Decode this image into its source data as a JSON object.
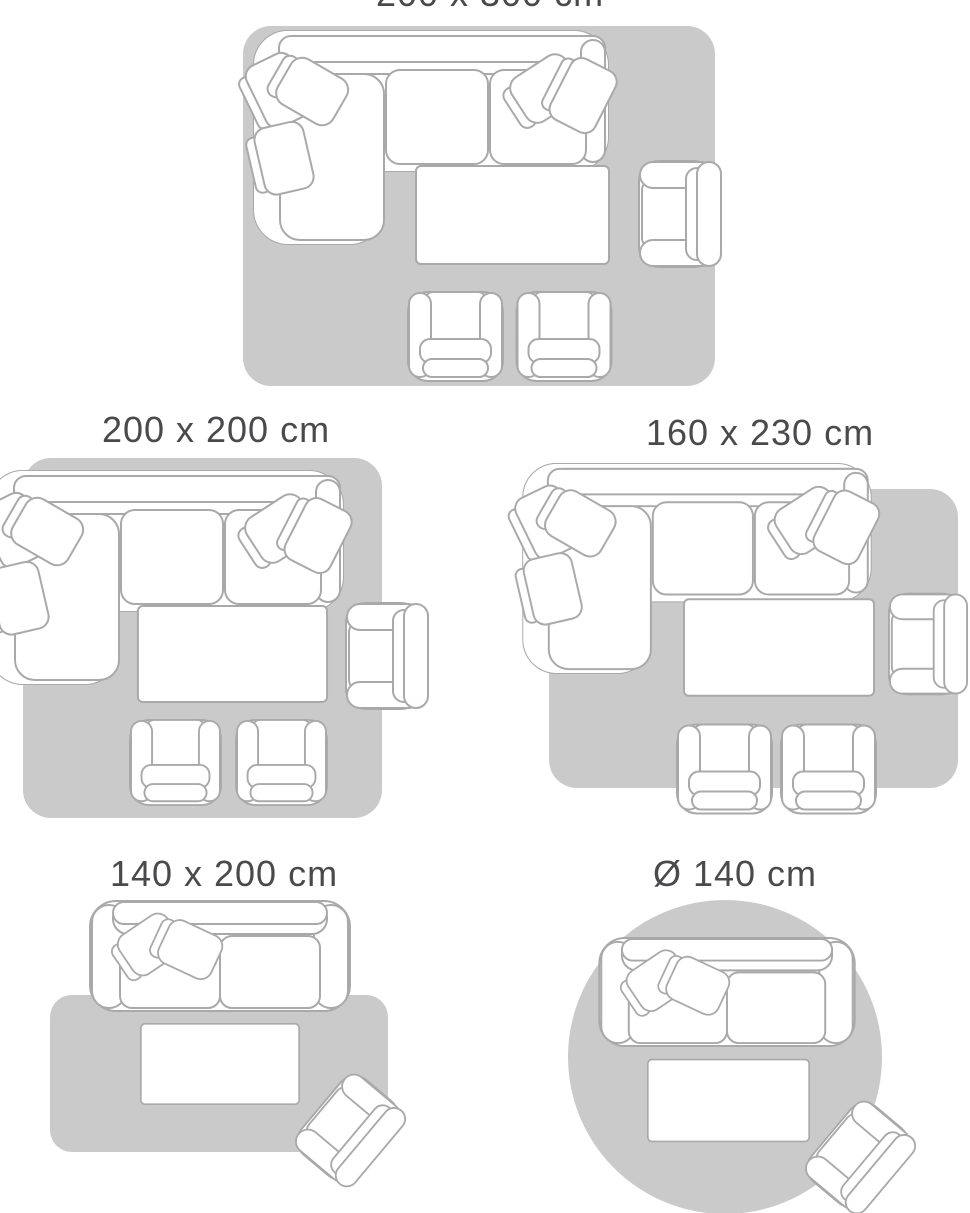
{
  "colors": {
    "background": "#ffffff",
    "rug": "#cacaca",
    "furniture_outline": "#a9a9a9",
    "furniture_fill": "#ffffff",
    "label_text": "#4a4a4c"
  },
  "scenes": [
    {
      "id": "200x300",
      "label": "200 x 300 cm",
      "rug_shape": "rectangle"
    },
    {
      "id": "200x200",
      "label": "200 x 200 cm",
      "rug_shape": "rectangle"
    },
    {
      "id": "160x230",
      "label": "160 x 230 cm",
      "rug_shape": "rectangle"
    },
    {
      "id": "140x200",
      "label": "140 x 200 cm",
      "rug_shape": "rectangle"
    },
    {
      "id": "diameter-140",
      "label": "Ø 140 cm",
      "rug_shape": "circle"
    }
  ]
}
